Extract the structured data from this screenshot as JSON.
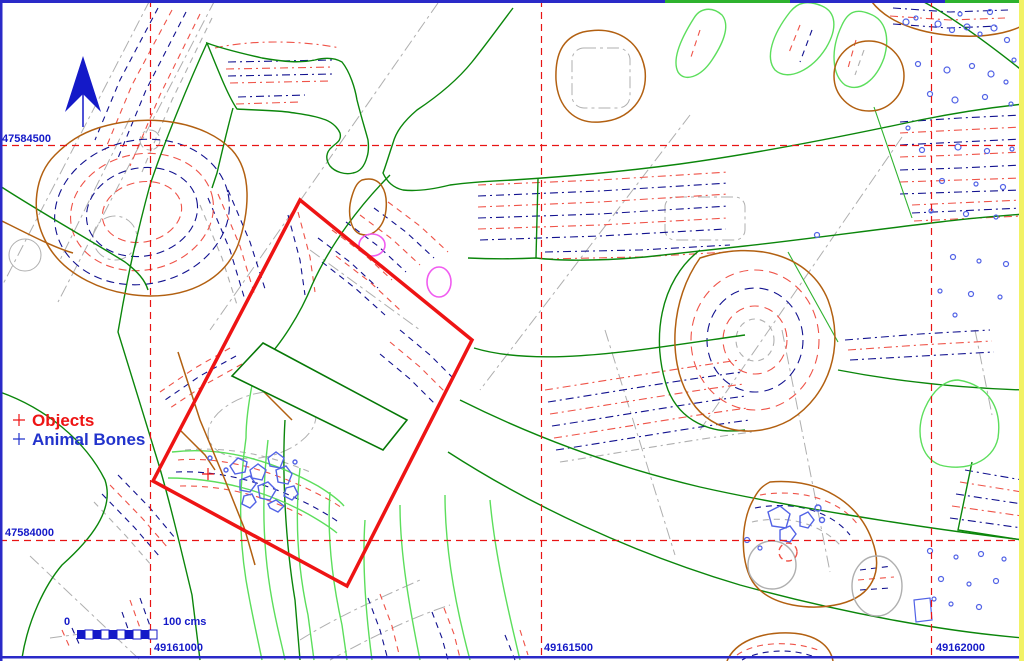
{
  "map": {
    "description": "archaeological excavation site plan with contour lines",
    "background": "#FFFFFF"
  },
  "grid": {
    "vertical_lines": [
      {
        "label": "49161000",
        "x": 150
      },
      {
        "label": "49161500",
        "x": 541
      },
      {
        "label": "49162000",
        "x": 931
      }
    ],
    "horizontal_lines": [
      {
        "label": "47584500",
        "y": 145
      },
      {
        "label": "47584000",
        "y": 540
      }
    ]
  },
  "legend": {
    "items": [
      {
        "label": "Objects",
        "color": "#EE1414",
        "marker": "red-dot"
      },
      {
        "label": "Animal Bones",
        "color": "#2233CC",
        "marker": "blue-dot"
      }
    ]
  },
  "scale_bar": {
    "start_label": "0",
    "end_label": "100 cms"
  },
  "north_arrow": {
    "direction": "up",
    "color": "#1419C8"
  },
  "survey_area": {
    "shape": "rotated-rectangle",
    "outline_color": "#EE1414"
  },
  "markers": {
    "objects": [
      {
        "x": 208,
        "y": 474
      }
    ],
    "animal_bones": [
      {
        "x": 305,
        "y": 234
      }
    ]
  },
  "palette": {
    "grid_red": "#E81414",
    "label_blue": "#1419C8",
    "border_blue": "#2A2AC8",
    "border_yellow": "#F2F266",
    "contour_green_dark": "#0B860B",
    "contour_green_light": "#5CDE5C",
    "contour_brown": "#B26011",
    "contour_navy_dashed": "#12128F",
    "contour_red_dashed": "#EF5348",
    "contour_gray_dashed": "#AFAFAF",
    "pit_magenta": "#F05CF0",
    "bones_blue": "#5263E6"
  }
}
